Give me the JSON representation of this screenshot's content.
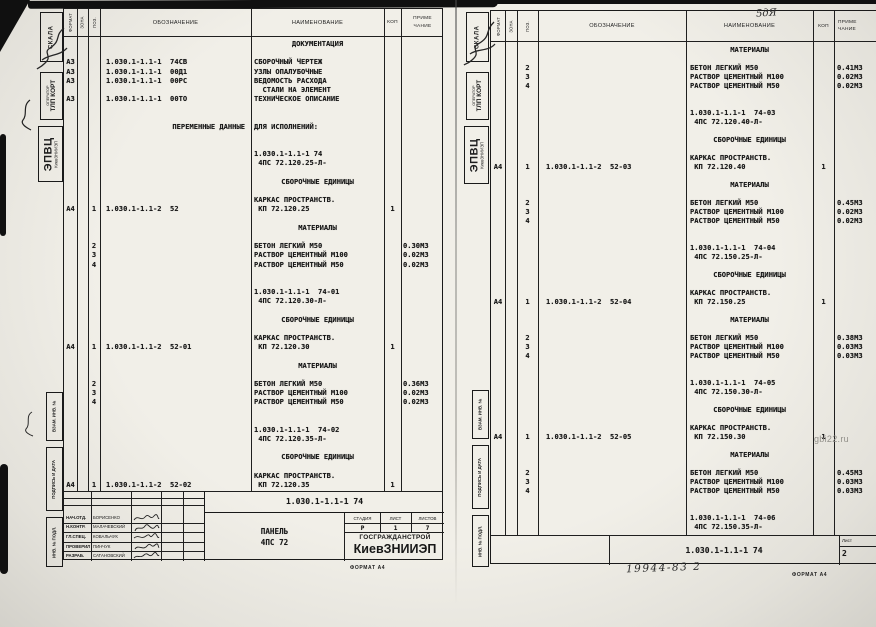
{
  "columns": {
    "format": "ФОРМАТ",
    "zone": "ЗОНА",
    "pos": "ПОЗ.",
    "designation": "ОБОЗНАЧЕНИЕ",
    "name": "НАИМЕНОВАНИЕ",
    "qty": "КОП",
    "note1": "ПРИМЕ",
    "note2": "ЧАНИЕ"
  },
  "margin": {
    "scala": "СКАЛА",
    "operator1": "ОПЕРАТОР",
    "operator2": "ТЛП КОРТ",
    "org1": "ЭПВЦ",
    "org2": "КиевЗНИИЭП",
    "vzam": "ВЗАМ. ИНВ. №",
    "sign": "ПОДПИСЬ И ДАТА",
    "inv": "ИНВ. № ПОДЛ."
  },
  "format_note": "ФОРМАТ А4",
  "annotations": {
    "header_mark": "5дЯ",
    "doc_number": "19944-83  2",
    "watermark": "gbi22.ru"
  },
  "left_page": {
    "rows": [
      {
        "n": "ДОКУМЕНТАЦИЯ",
        "c": 1
      },
      {},
      {
        "f": "А3",
        "d": "1.030.1-1.1-1  74СВ",
        "n": "СБОРОЧНЫЙ ЧЕРТЕЖ"
      },
      {
        "f": "А3",
        "d": "1.030.1-1.1-1  00Д1",
        "n": "УЗЛЫ ОПАЛУБОЧНЫЕ"
      },
      {
        "f": "А3",
        "d": "1.030.1-1.1-1  00РС",
        "n": "ВЕДОМОСТЬ РАСХОДА"
      },
      {
        "n": "  СТАЛИ НА ЭЛЕМЕНТ"
      },
      {
        "f": "А3",
        "d": "1.030.1-1.1-1  00ТО",
        "n": "ТЕХНИЧЕСКОЕ ОПИСАНИЕ"
      },
      {},
      {},
      {
        "d": "ПЕРЕМЕННЫЕ ДАННЫЕ",
        "dr": 1,
        "n": "ДЛЯ ИСПОЛНЕНИЙ:"
      },
      {},
      {},
      {
        "n": "1.030.1-1.1-1 74"
      },
      {
        "n": " 4ПС 72.120.25-Л-"
      },
      {},
      {
        "n": "СБОРОЧНЫЕ ЕДИНИЦЫ",
        "c": 1
      },
      {},
      {
        "n": "КАРКАС ПРОСТРАНСТВ."
      },
      {
        "f": "А4",
        "p": "1",
        "d": "1.030.1-1.1-2  52",
        "n": " КП 72.120.25",
        "q": "1"
      },
      {},
      {
        "n": "МАТЕРИАЛЫ",
        "c": 1
      },
      {},
      {
        "p": "2",
        "n": "БЕТОН ЛЕГКИЙ М50",
        "r": "0.30М3"
      },
      {
        "p": "3",
        "n": "РАСТВОР ЦЕМЕНТНЫЙ М100",
        "r": "0.02М3"
      },
      {
        "p": "4",
        "n": "РАСТВОР ЦЕМЕНТНЫЙ М50",
        "r": "0.02М3"
      },
      {},
      {},
      {
        "n": "1.030.1-1.1-1  74-01"
      },
      {
        "n": " 4ПС 72.120.30-Л-"
      },
      {},
      {
        "n": "СБОРОЧНЫЕ ЕДИНИЦЫ",
        "c": 1
      },
      {},
      {
        "n": "КАРКАС ПРОСТРАНСТВ."
      },
      {
        "f": "А4",
        "p": "1",
        "d": "1.030.1-1.1-2  52-01",
        "n": " КП 72.120.30",
        "q": "1"
      },
      {},
      {
        "n": "МАТЕРИАЛЫ",
        "c": 1
      },
      {},
      {
        "p": "2",
        "n": "БЕТОН ЛЕГКИЙ М50",
        "r": "0.36М3"
      },
      {
        "p": "3",
        "n": "РАСТВОР ЦЕМЕНТНЫЙ М100",
        "r": "0.02М3"
      },
      {
        "p": "4",
        "n": "РАСТВОР ЦЕМЕНТНЫЙ М50",
        "r": "0.02М3"
      },
      {},
      {},
      {
        "n": "1.030.1-1.1-1  74-02"
      },
      {
        "n": " 4ПС 72.120.35-Л-"
      },
      {},
      {
        "n": "СБОРОЧНЫЕ ЕДИНИЦЫ",
        "c": 1
      },
      {},
      {
        "n": "КАРКАС ПРОСТРАНСТВ."
      },
      {
        "f": "А4",
        "p": "1",
        "d": "1.030.1-1.1-2  52-02",
        "n": " КП 72.120.35",
        "q": "1"
      }
    ],
    "title_block": {
      "designation": "1.030.1-1.1-1 74",
      "rows": [
        {
          "role": "НАЧ.ОТД.",
          "name": "БОРИСЕНКО"
        },
        {
          "role": "Н.КОНТР.",
          "name": "МАЛАЧЕВСКИЙ"
        },
        {
          "role": "ГЛ.СПЕЦ.",
          "name": "КОВАЛЬЧУК"
        },
        {
          "role": "ПРОВЕРИЛ",
          "name": "ПИНЧУК"
        },
        {
          "role": "РАЗРАБ.",
          "name": "САТАНОВСКИЙ"
        }
      ],
      "subject1": "ПАНЕЛЬ",
      "subject2": "4ПС 72",
      "stage_label": "СТАДИЯ",
      "sheet_label": "ЛИСТ",
      "sheets_label": "ЛИСТОВ",
      "stage": "Р",
      "sheet": "1",
      "sheets": "7",
      "org1": "ГОСГРАЖДАНСТРОЙ",
      "org2": "КиевЗНИИЭП"
    }
  },
  "right_page": {
    "rows": [
      {
        "n": "МАТЕРИАЛЫ",
        "c": 1
      },
      {},
      {
        "p": "2",
        "n": "БЕТОН ЛЕГКИЙ М50",
        "r": "0.41М3"
      },
      {
        "p": "3",
        "n": "РАСТВОР ЦЕМЕНТНЫЙ М100",
        "r": "0.02М3"
      },
      {
        "p": "4",
        "n": "РАСТВОР ЦЕМЕНТНЫЙ М50",
        "r": "0.02М3"
      },
      {},
      {},
      {
        "n": "1.030.1-1.1-1  74-03"
      },
      {
        "n": " 4ПС 72.120.40-Л-"
      },
      {},
      {
        "n": "СБОРОЧНЫЕ ЕДИНИЦЫ",
        "c": 1
      },
      {},
      {
        "n": "КАРКАС ПРОСТРАНСТВ."
      },
      {
        "f": "А4",
        "p": "1",
        "d": "1.030.1-1.1-2  52-03",
        "n": " КП 72.120.40",
        "q": "1"
      },
      {},
      {
        "n": "МАТЕРИАЛЫ",
        "c": 1
      },
      {},
      {
        "p": "2",
        "n": "БЕТОН ЛЕГКИЙ М50",
        "r": "0.45М3"
      },
      {
        "p": "3",
        "n": "РАСТВОР ЦЕМЕНТНЫЙ М100",
        "r": "0.02М3"
      },
      {
        "p": "4",
        "n": "РАСТВОР ЦЕМЕНТНЫЙ М50",
        "r": "0.02М3"
      },
      {},
      {},
      {
        "n": "1.030.1-1.1-1  74-04"
      },
      {
        "n": " 4ПС 72.150.25-Л-"
      },
      {},
      {
        "n": "СБОРОЧНЫЕ ЕДИНИЦЫ",
        "c": 1
      },
      {},
      {
        "n": "КАРКАС ПРОСТРАНСТВ."
      },
      {
        "f": "А4",
        "p": "1",
        "d": "1.030.1-1.1-2  52-04",
        "n": " КП 72.150.25",
        "q": "1"
      },
      {},
      {
        "n": "МАТЕРИАЛЫ",
        "c": 1
      },
      {},
      {
        "p": "2",
        "n": "БЕТОН ЛЕГКИЙ М50",
        "r": "0.38М3"
      },
      {
        "p": "3",
        "n": "РАСТВОР ЦЕМЕНТНЫЙ М100",
        "r": "0.03М3"
      },
      {
        "p": "4",
        "n": "РАСТВОР ЦЕМЕНТНЫЙ М50",
        "r": "0.03М3"
      },
      {},
      {},
      {
        "n": "1.030.1-1.1-1  74-05"
      },
      {
        "n": " 4ПС 72.150.30-Л-"
      },
      {},
      {
        "n": "СБОРОЧНЫЕ ЕДИНИЦЫ",
        "c": 1
      },
      {},
      {
        "n": "КАРКАС ПРОСТРАНСТВ."
      },
      {
        "f": "А4",
        "p": "1",
        "d": "1.030.1-1.1-2  52-05",
        "n": " КП 72.150.30",
        "q": "1"
      },
      {},
      {
        "n": "МАТЕРИАЛЫ",
        "c": 1
      },
      {},
      {
        "p": "2",
        "n": "БЕТОН ЛЕГКИЙ М50",
        "r": "0.45М3"
      },
      {
        "p": "3",
        "n": "РАСТВОР ЦЕМЕНТНЫЙ М100",
        "r": "0.03М3"
      },
      {
        "p": "4",
        "n": "РАСТВОР ЦЕМЕНТНЫЙ М50",
        "r": "0.03М3"
      },
      {},
      {},
      {
        "n": "1.030.1-1.1-1  74-06"
      },
      {
        "n": " 4ПС 72.150.35-Л-"
      }
    ],
    "footer": {
      "designation": "1.030.1-1.1-1 74",
      "sheet_label": "Лист",
      "sheet": "2"
    }
  }
}
